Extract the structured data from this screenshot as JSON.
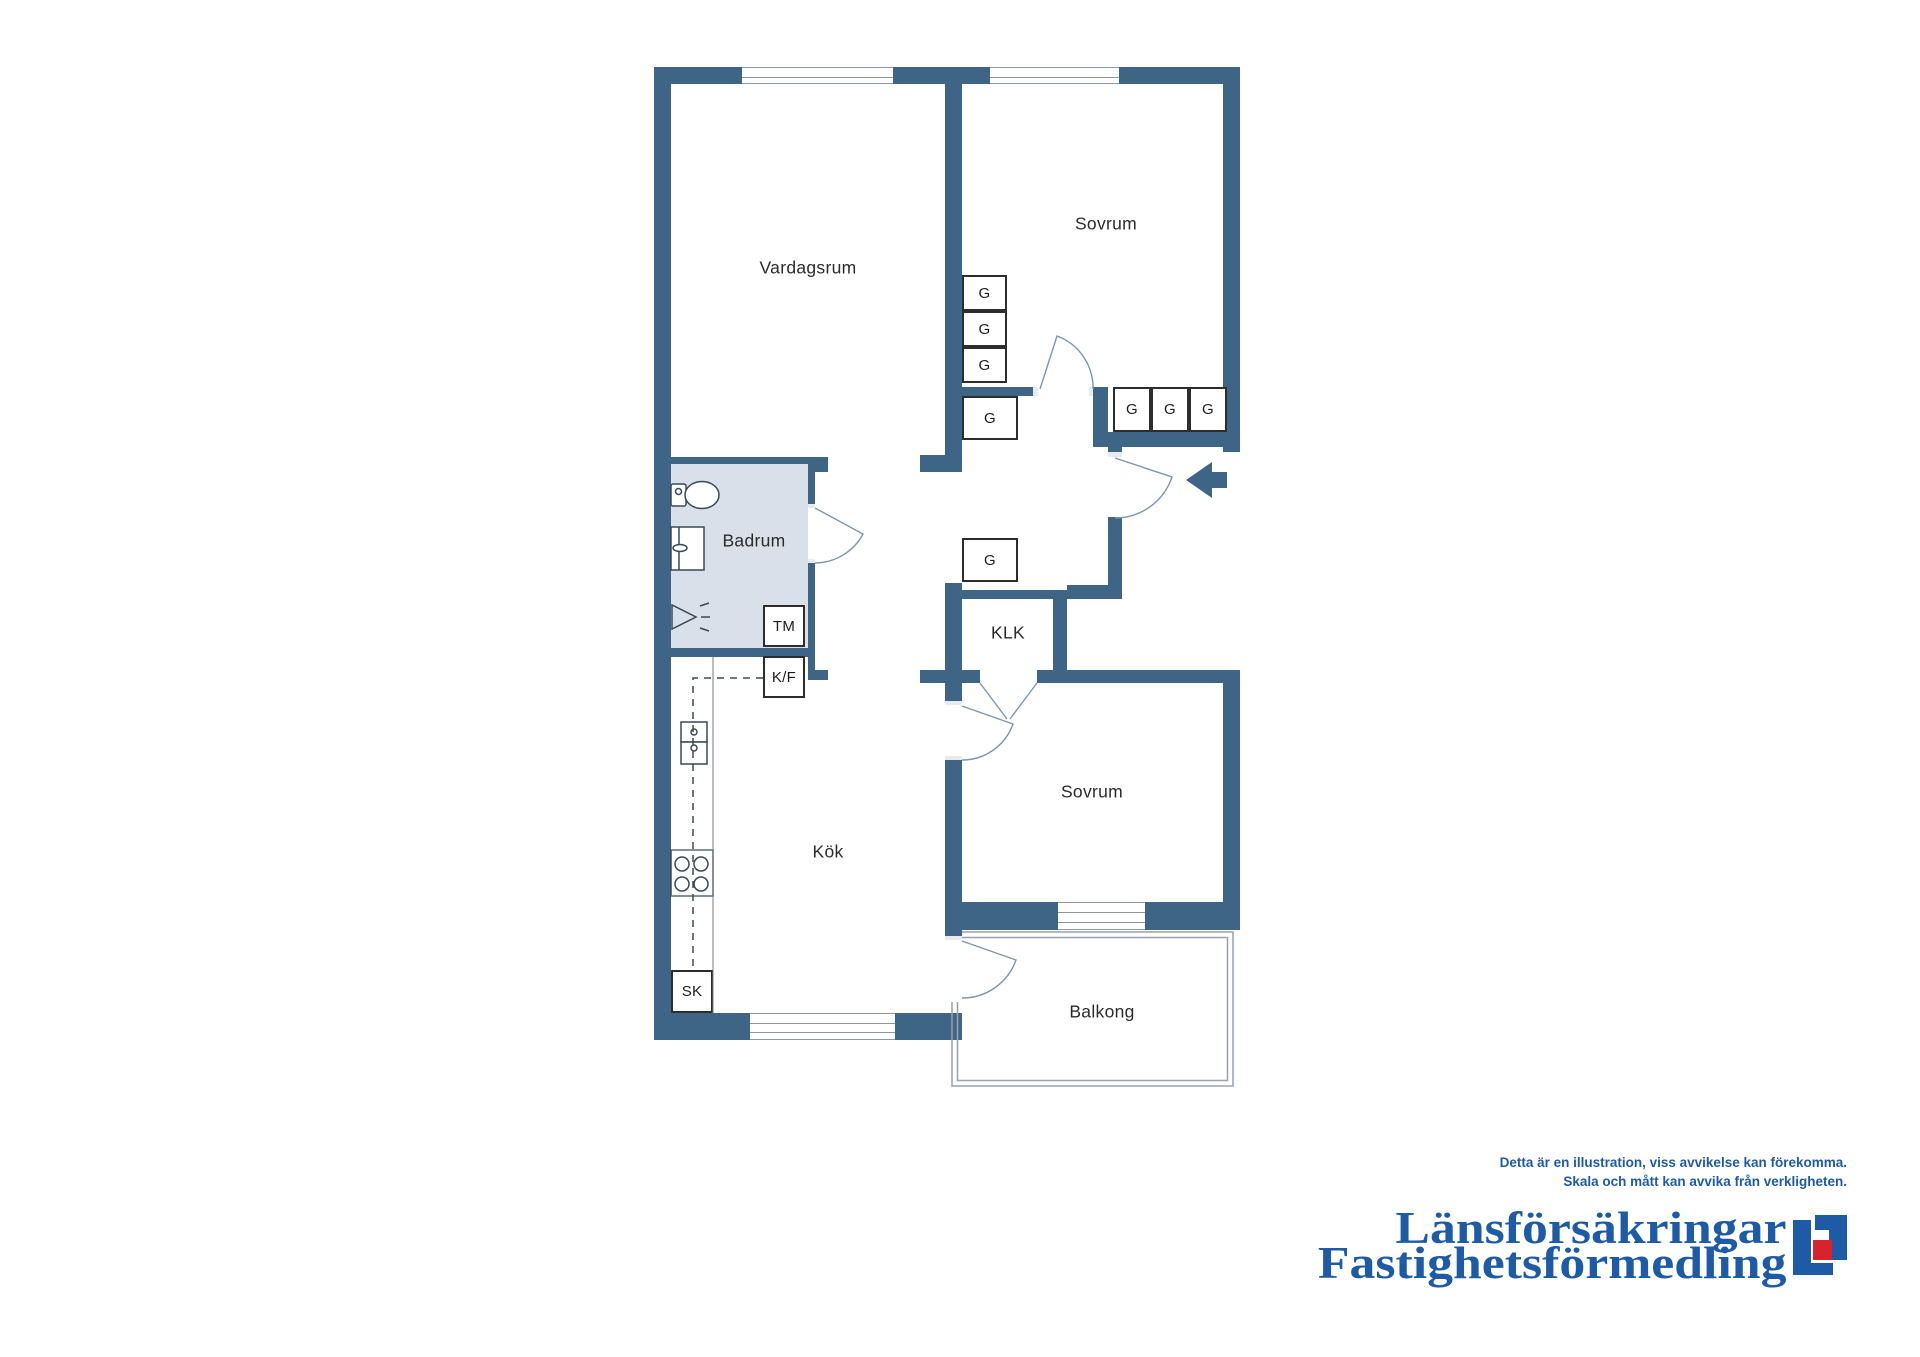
{
  "colors": {
    "wall": "#3e6586",
    "bath": "#d9e0ea",
    "wline": "#8b97a3",
    "boxb": "#2d2d2d",
    "label": "#2b2b2b",
    "arc": "#7e96ac",
    "fixture": "#3c4856",
    "counter": "#707c88",
    "dash": "#3f4a55",
    "balcony": "#98a1ad",
    "brand": "#1e5ba6",
    "brandred": "#d8232a"
  },
  "plan": {
    "bath_fill": [
      671,
      464,
      137,
      184
    ],
    "walls": [
      [
        654,
        67,
        88,
        17
      ],
      [
        893,
        67,
        97,
        17
      ],
      [
        1119,
        67,
        121,
        17
      ],
      [
        654,
        67,
        17,
        973
      ],
      [
        654,
        1013,
        96,
        27
      ],
      [
        895,
        1013,
        67,
        27
      ],
      [
        1223,
        67,
        17,
        385
      ],
      [
        1223,
        670,
        17,
        260
      ],
      [
        945,
        902,
        113,
        28
      ],
      [
        1145,
        902,
        95,
        28
      ],
      [
        945,
        84,
        17,
        388
      ],
      [
        920,
        455,
        42,
        17
      ],
      [
        962,
        387,
        76,
        9
      ],
      [
        1093,
        387,
        15,
        60
      ],
      [
        1093,
        432,
        147,
        15
      ],
      [
        1108,
        447,
        14,
        10
      ],
      [
        1108,
        517,
        14,
        68
      ],
      [
        1067,
        585,
        55,
        14
      ],
      [
        945,
        590,
        122,
        9
      ],
      [
        1053,
        598,
        14,
        72
      ],
      [
        945,
        583,
        17,
        87
      ],
      [
        920,
        670,
        42,
        13
      ],
      [
        962,
        670,
        18,
        13
      ],
      [
        945,
        683,
        17,
        22
      ],
      [
        945,
        760,
        17,
        142
      ],
      [
        945,
        930,
        17,
        10
      ],
      [
        654,
        457,
        161,
        7
      ],
      [
        808,
        457,
        20,
        15
      ],
      [
        808,
        464,
        7,
        44
      ],
      [
        808,
        563,
        7,
        117
      ],
      [
        808,
        670,
        20,
        10
      ],
      [
        654,
        648,
        161,
        9
      ],
      [
        1037,
        670,
        203,
        13
      ]
    ],
    "notches": [
      [
        1108,
        452,
        14,
        5
      ],
      [
        808,
        504,
        7,
        4
      ],
      [
        808,
        559,
        7,
        4
      ],
      [
        945,
        701,
        17,
        4
      ],
      [
        945,
        756,
        17,
        4
      ],
      [
        945,
        936,
        17,
        4
      ],
      [
        1089,
        387,
        4,
        9
      ],
      [
        1033,
        387,
        5,
        9
      ]
    ],
    "windows": [
      [
        742,
        67,
        151,
        17
      ],
      [
        990,
        67,
        129,
        17
      ],
      [
        750,
        1013,
        145,
        27
      ],
      [
        1058,
        902,
        87,
        28
      ]
    ],
    "boxes": [
      {
        "label": "G",
        "x": 962,
        "y": 275,
        "w": 45,
        "h": 36
      },
      {
        "label": "G",
        "x": 962,
        "y": 311,
        "w": 45,
        "h": 36
      },
      {
        "label": "G",
        "x": 962,
        "y": 347,
        "w": 45,
        "h": 36
      },
      {
        "label": "G",
        "x": 962,
        "y": 396,
        "w": 56,
        "h": 44
      },
      {
        "label": "G",
        "x": 1113,
        "y": 387,
        "w": 38,
        "h": 45
      },
      {
        "label": "G",
        "x": 1151,
        "y": 387,
        "w": 38,
        "h": 45
      },
      {
        "label": "G",
        "x": 1189,
        "y": 387,
        "w": 38,
        "h": 45
      },
      {
        "label": "G",
        "x": 962,
        "y": 538,
        "w": 56,
        "h": 44
      },
      {
        "label": "TM",
        "x": 763,
        "y": 605,
        "w": 42,
        "h": 42
      },
      {
        "label": "K/F",
        "x": 763,
        "y": 656,
        "w": 42,
        "h": 42
      },
      {
        "label": "SK",
        "x": 671,
        "y": 970,
        "w": 42,
        "h": 43
      }
    ],
    "room_labels": [
      {
        "text": "Vardagsrum",
        "x": 808,
        "y": 268
      },
      {
        "text": "Sovrum",
        "x": 1106,
        "y": 224
      },
      {
        "text": "Badrum",
        "x": 754,
        "y": 541
      },
      {
        "text": "KLK",
        "x": 1008,
        "y": 633
      },
      {
        "text": "Sovrum",
        "x": 1092,
        "y": 792
      },
      {
        "text": "Kök",
        "x": 828,
        "y": 852
      },
      {
        "text": "Balkong",
        "x": 1102,
        "y": 1012
      }
    ],
    "svg": {
      "fixtures": [
        "<rect x='671' y='484' width='15' height='22' rx='2'/>",
        "<circle cx='678.5' cy='491.5' r='3'/>",
        "<ellipse cx='702' cy='495' rx='17' ry='13.5'/>",
        "<rect x='671' y='527' width='33' height='43'/>",
        "<line x1='679' y1='527' x2='679' y2='570'/>",
        "<ellipse cx='680' cy='548' rx='7' ry='3.5'/>",
        "<path d='M672,605 L672,629 L696,617 Z' fill='none'/>",
        "<line x1='700' y1='606' x2='709' y2='603'/>",
        "<line x1='701' y1='617' x2='710' y2='617'/>",
        "<line x1='700' y1='628' x2='709' y2='631'/>",
        "<rect x='681' y='722' width='26' height='20'/>",
        "<rect x='681' y='742' width='26' height='22'/>",
        "<circle cx='694' cy='732' r='3'/>",
        "<circle cx='694' cy='748' r='3'/>",
        "<rect x='671' y='850' width='42' height='46'/>",
        "<circle cx='682' cy='864' r='7'/>",
        "<circle cx='701' cy='864' r='7'/>",
        "<circle cx='682' cy='884' r='7'/>",
        "<circle cx='701' cy='884' r='7'/>"
      ],
      "counter": [
        "<line x1='713' y1='657' x2='713' y2='1013'/>",
        "<line x1='671' y1='850' x2='713' y2='850'/>",
        "<line x1='671' y1='896' x2='713' y2='896'/>"
      ],
      "dashed": [
        "<path d='M763,678 H693 V970'/>"
      ],
      "doors": [
        "<path d='M815,508 L863,534 A55,55 0 0 1 815,563'/>",
        "<path d='M1040,389 L1057,336 A55,55 0 0 1 1093,389'/>",
        "<path d='M1115,458 L1172,477 A60,60 0 0 1 1115,518'/>",
        "<path d='M962,941 L1016,960 A57,57 0 0 1 962,998'/>",
        "<path d='M962,706 L1013,724 A54,54 0 0 1 962,760'/>",
        "<path d='M980,683 L1007,719'/>",
        "<path d='M1037,683 L1010,719'/>"
      ],
      "balcony": [
        "<path d='M962,932 H1233 V1086 H952 V1002'/>",
        "<path d='M962,937.5 H1227.5 V1080.5 H957.5 V1002'/>"
      ],
      "arrow": "<polygon points='1186,480 1212,462 1212,472 1227,472 1227,488 1212,488 1212,498'/>"
    }
  },
  "footer": {
    "line1": "Detta är en illustration, viss avvikelse kan förekomma.",
    "line2": "Skala och mått kan avvika från verkligheten."
  },
  "logo": {
    "line1": "Länsförsäkringar",
    "line2": "Fastighetsförmedling"
  }
}
